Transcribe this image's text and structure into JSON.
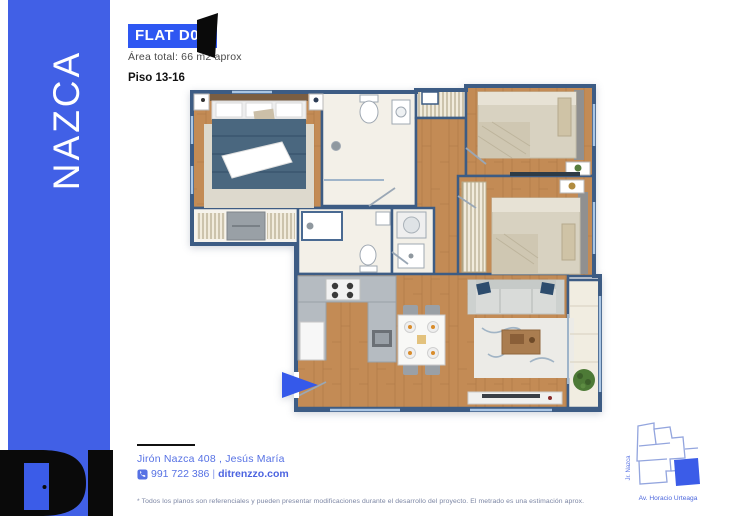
{
  "sidebar": {
    "brand": "NAZCA"
  },
  "logo": {
    "label": "DI"
  },
  "header": {
    "badge": "FLAT D01",
    "area": "Área total: 66 m2 aprox",
    "floor": "Piso 13-16"
  },
  "plan": {
    "rooms": [
      "master-bedroom",
      "bathroom-1",
      "bedroom-2",
      "bedroom-3",
      "bathroom-2",
      "laundry",
      "kitchen",
      "dining",
      "living-room",
      "balcony"
    ],
    "entrance_marker": "blue-arrow"
  },
  "contact": {
    "address": "Jirón Nazca 408 , Jesús María",
    "phone": "991 722 386",
    "separator": "|",
    "website": "ditrenzzo.com"
  },
  "disclaimer": "* Todos los planos son referenciales y pueden presentar modificaciones durante el desarrollo del proyecto. El metrado es una estimación aprox.",
  "map": {
    "street_left": "Jr. Nazca",
    "street_bottom": "Av. Horacio Urteaga"
  },
  "colors": {
    "brand_blue": "#4160e6",
    "badge_blue": "#2e57f2",
    "accent_blue": "#3559ea",
    "wall_blue": "#3d5c84",
    "wood": "#c38b55",
    "footer_blue": "#5671e4"
  }
}
